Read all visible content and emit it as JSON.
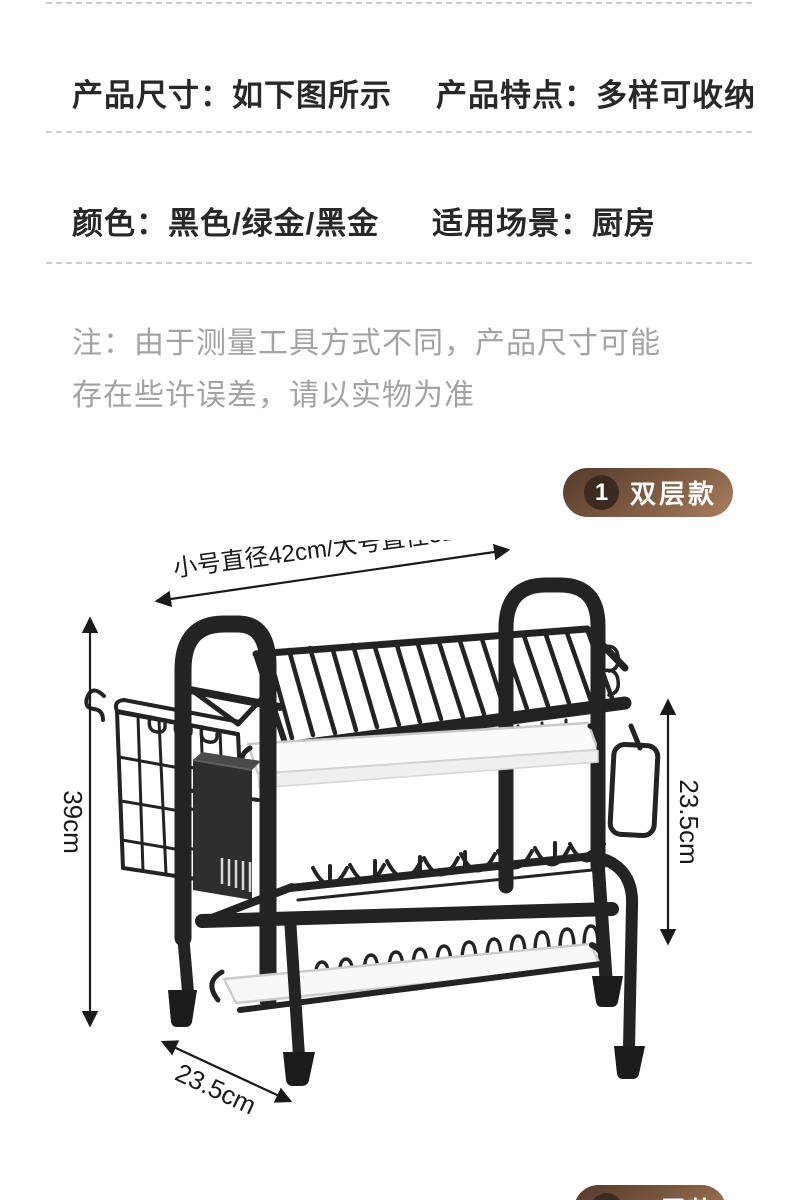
{
  "specs": {
    "row1_left": "产品尺寸：如下图所示",
    "row1_right": "产品特点：多样可收纳",
    "row2_left": "颜色：黑色/绿金/黑金",
    "row2_right": "适用场景：厨房"
  },
  "note": {
    "line1": "注：由于测量工具方式不同，产品尺寸可能",
    "line2": "存在些许误差，请以实物为准"
  },
  "badge1": {
    "number": "1",
    "label": "双层款"
  },
  "badge2": {
    "number": "2",
    "label": "三层款"
  },
  "dimensions": {
    "top_width": "小号直径42cm/大号直径52cm",
    "height": "39cm",
    "right_depth": "23.5cm",
    "bottom_depth": "23.5cm"
  },
  "colors": {
    "heading_text": "#282828",
    "note_text": "#a3a3a3",
    "divider": "#cdcdcd",
    "badge_gradient_start": "#54392a",
    "badge_gradient_end": "#a97e5e",
    "badge_circle": "#3a2a1f",
    "badge_text": "#ffffff",
    "rack_black": "#232323",
    "tray_white": "#fafafa",
    "dimension_line": "#1a1a1a"
  }
}
